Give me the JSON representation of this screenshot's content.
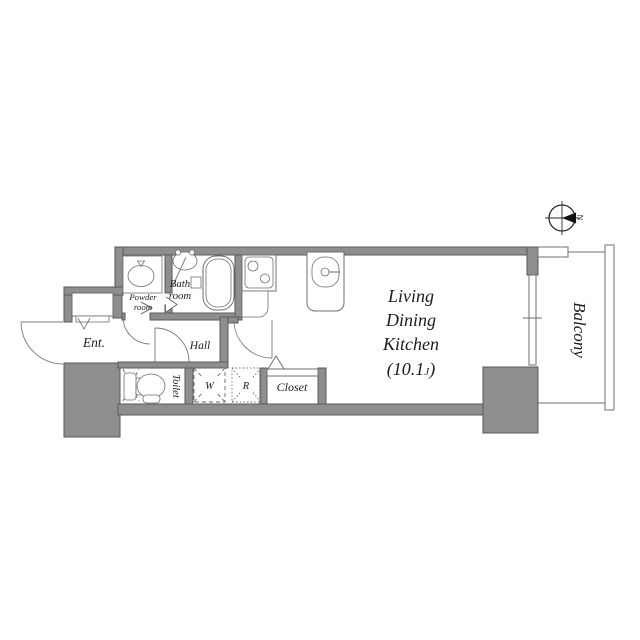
{
  "colors": {
    "wall": "#8e8e8e",
    "wall_line": "#5a5a5a",
    "line": "#6f6f6f",
    "ink": "#1c1c1c",
    "needle": "#111111",
    "background": "#ffffff"
  },
  "rooms": {
    "entrance": {
      "label": "Ent."
    },
    "powder_room": {
      "label_line1": "Powder",
      "label_line2": "room"
    },
    "bath_room": {
      "label_line1": "Bath",
      "label_line2": "room"
    },
    "hall": {
      "label": "Hall"
    },
    "toilet": {
      "label": "Toilet"
    },
    "washer_space": {
      "label": "W"
    },
    "refrigerator_space": {
      "label": "R"
    },
    "closet": {
      "label": "Closet"
    },
    "ldk": {
      "line1": "Living",
      "line2": "Dining",
      "line3": "Kitchen",
      "area_prefix": "(10.1",
      "area_unit": "J",
      "area_suffix": ")"
    },
    "balcony": {
      "label": "Balcony"
    }
  },
  "compass": {
    "north_label": "N"
  }
}
